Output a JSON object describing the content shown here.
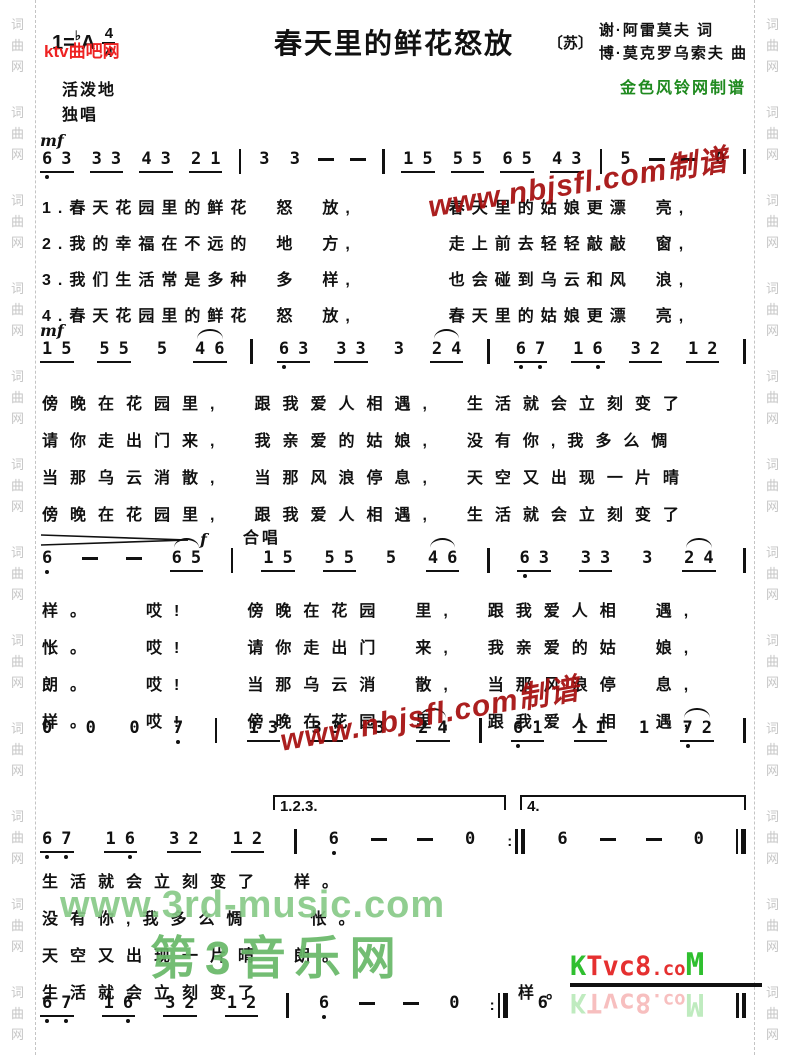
{
  "margin": {
    "text": "词曲网",
    "repeat": 12
  },
  "header": {
    "key": "1=",
    "key_flat": "♭",
    "key_note": "A",
    "time_num": "4",
    "time_den": "4",
    "tempo": "活泼地",
    "voice": "独唱",
    "title": "春天里的鲜花怒放",
    "origin": "〔苏〕",
    "lyricist": "谢·阿雷莫夫 词",
    "composer": "博·莫克罗乌索夫 曲",
    "publisher": "金色风铃网制谱"
  },
  "watermarks": {
    "ktvquba": "ktv曲吧网",
    "nbjsfl": "www.nbjsfl.com制谱",
    "third_music": "www.3rd-music.com",
    "third_music_cn": "第3音乐网",
    "ktvc8": {
      "p1": "K",
      "p2": "Tvc8",
      "p3": ".co",
      "p4": "M"
    }
  },
  "systems": [
    {
      "dynamic": "mf",
      "label": "",
      "tokens": [
        "6_,3",
        "3,3",
        "4,3",
        "2,1",
        "|",
        "3",
        "3",
        "-",
        "-",
        "|",
        "1,5",
        "5,5",
        "6,5",
        "4,3",
        "|",
        "5",
        "-",
        "-",
        "0",
        "|"
      ]
    },
    {
      "dynamic": "mf",
      "label": "",
      "tokens": [
        "1,5",
        "5,5",
        "5",
        "~4,6",
        "|",
        "6_,3",
        "3,3",
        "3",
        "~2,4",
        "|",
        "6_,7_",
        "1,6_",
        "3,2",
        "1,2",
        "|"
      ]
    },
    {
      "dynamic": "f",
      "label": "合唱",
      "hairpin": true,
      "tokens": [
        "6_",
        "-",
        "-",
        "~6,5",
        "|",
        "1,5",
        "5,5",
        "5",
        "~4,6",
        "|",
        "6_,3",
        "3,3",
        "3",
        "~2,4",
        "|"
      ]
    },
    {
      "dynamic": "",
      "label": "",
      "tokens": [
        "0",
        "0",
        "0",
        "7_",
        "|",
        "1,3",
        "3,3",
        "3",
        "~2,4",
        "|",
        "6_,1",
        "1,1",
        "1",
        "~7_,2",
        "|"
      ]
    },
    {
      "dynamic": "",
      "label": "",
      "volta": [
        {
          "label": "1.2.3."
        },
        {
          "label": "4."
        }
      ],
      "tokens": [
        "6_,7_",
        "1,6_",
        "3,2",
        "1,2",
        "|",
        "6_",
        "-",
        "-",
        "0",
        ":||",
        "6",
        "-",
        "-",
        "0",
        "||"
      ]
    },
    {
      "dynamic": "",
      "label": "",
      "tokens": [
        "6_,7_",
        "1,6_",
        "3,2",
        "1,2",
        "|",
        "6_",
        "-",
        "-",
        "0",
        ":||",
        "6",
        "sp",
        "||"
      ]
    }
  ],
  "lyrics": {
    "verses": [
      "1.春天花园里的鲜花　怒　放,　　　　春天里的姑娘更漂　亮,",
      "2.我的幸福在不远的　地　方,　　　　走上前去轻轻敲敲　窗,",
      "3.我们生活常是多种　多　样,　　　　也会碰到乌云和风　浪,",
      "4.春天花园里的鲜花　怒　放,　　　　春天里的姑娘更漂　亮,"
    ],
    "block2": [
      "傍晚在花园里,　跟我爱人相遇,　生活就会立刻变了",
      "请你走出门来,　我亲爱的姑娘,　没有你,我多么惆",
      "当那乌云消散,　当那风浪停息,　天空又出现一片晴",
      "傍晚在花园里,　跟我爱人相遇,　生活就会立刻变了"
    ],
    "chorus": [
      "样。　　哎!　　傍晚在花园　里,　跟我爱人相　遇,",
      "怅。　　哎!　　请你走出门　来,　我亲爱的姑　娘,",
      "朗。　　哎!　　当那乌云消　散,　当那风浪停　息,",
      "样。　　哎!　　傍晚在花园　里,　跟我爱人相　遇,"
    ],
    "outro": [
      "生活就会立刻变了　样。",
      "没有你,我多么惆　　怅。",
      "天空又出现一片晴　朗。",
      "生活就会立刻变了　　　　　　　　　样。"
    ]
  }
}
